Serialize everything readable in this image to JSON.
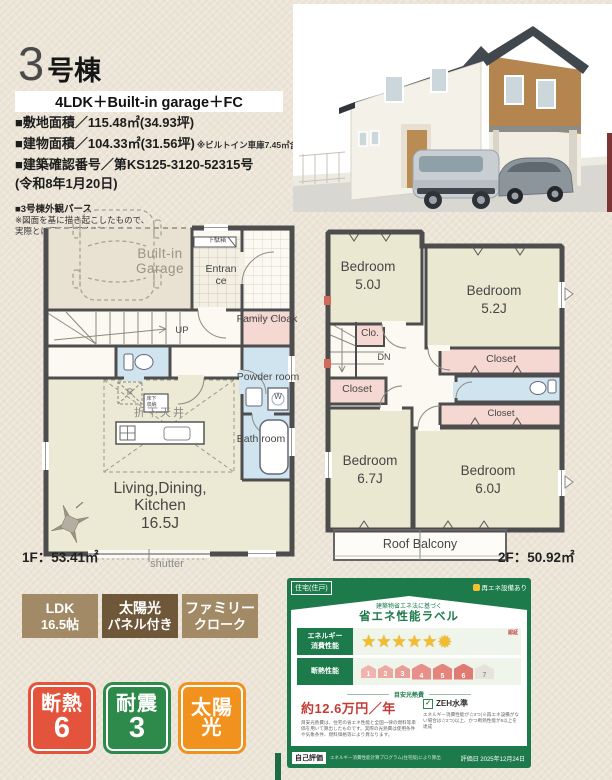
{
  "header": {
    "unit_no": "3",
    "unit_suffix": "号棟",
    "plan_type": "4LDK＋Built-in garage＋FC",
    "spec_line1": "■敷地面積／115.48㎡(34.93坪)",
    "spec_line2": "■建物面積／104.33㎡(31.56坪)",
    "spec_line2_note": "※ビルトイン車庫7.45㎡含む",
    "spec_line3": "■建築確認番号／第KS125-3120-52315号",
    "spec_line4": "(令和8年1月20日)",
    "perspective_title": "■3号棟外観パース",
    "perspective_note1": "※図面を基に描き起こしたもので、",
    "perspective_note2": "実際とは異なる場合があります。"
  },
  "plan_1f": {
    "area": "1F：53.41㎡",
    "garage": "Built-in Garage",
    "shoe_cabinet": "下駄箱",
    "entrance": "Entrance",
    "family_cloak": "Family Cloak",
    "up": "UP",
    "powder_room": "Powder room",
    "washer": "W",
    "bath_room": "Bath room",
    "fridge": "R",
    "lowered_ceiling": "折下天井",
    "floor_storage": "床下収納",
    "ldk_name": "Living,Dining, Kitchen",
    "ldk_size": "16.5J",
    "shutter": "shutter"
  },
  "plan_2f": {
    "area": "2F：50.92㎡",
    "bedroom1_name": "Bedroom",
    "bedroom1_size": "5.0J",
    "bedroom2_name": "Bedroom",
    "bedroom2_size": "5.2J",
    "bedroom3_name": "Bedroom",
    "bedroom3_size": "6.7J",
    "bedroom4_name": "Bedroom",
    "bedroom4_size": "6.0J",
    "clo": "Clo.",
    "dn": "DN",
    "closet1": "Closet",
    "closet2": "Closet",
    "closet3": "Closet",
    "roof_balcony": "Roof Balcony"
  },
  "feature_badges": {
    "b1_line1": "LDK",
    "b1_line2": "16.5帖",
    "b2_line1": "太陽光",
    "b2_line2": "パネル付き",
    "b3_line1": "ファミリー",
    "b3_line2": "クローク"
  },
  "performance_badges": {
    "b1_label": "断熱",
    "b1_value": "6",
    "b2_label": "耐震",
    "b2_value": "3",
    "b3_line1": "太陽",
    "b3_line2": "光"
  },
  "energy_label": {
    "type_badge": "住宅(住戸)",
    "renewable_badge": "再エネ設備あり",
    "law_note": "建築物省エネ法に基づく",
    "title": "省エネ性能ラベル",
    "energy_row_label1": "エネルギー",
    "energy_row_label2": "消費性能",
    "certified": "認証",
    "star_char": "★",
    "burst_char": "✹",
    "stars_total": 6,
    "insulation_label": "断熱性能",
    "levels": [
      "1",
      "2",
      "3",
      "4",
      "5",
      "6",
      "7"
    ],
    "insulation_achieved": 6,
    "cost_heading": "目安光熱費",
    "annual_cost": "約12.6万円／年",
    "zeh": "ZEH水準",
    "zeh_note": "エネルギー消費性能が☆3つ(※再エネ設備がない場合は☆2つ)以上、かつ断熱性能が5以上を達成",
    "cost_note": "目安光熱費は、住宅の省エネ性能と全国一律の燃料等単価を用いて算出したものです。実際の光熱費は使用条件や気象条件、燃料価格等により異なります。",
    "self_eval": "自己評価",
    "self_eval_note": "エネルギー消費性能計算プログラム(住宅版)により算出",
    "eval_date": "評価日 2025年12月24日"
  },
  "colors": {
    "accent_red": "#e4543c",
    "accent_green": "#2e8a4b",
    "accent_orange": "#f0921d",
    "badge_tan": "#a28a66",
    "badge_brown": "#6e5839",
    "label_green": "#1d7a4b",
    "price_red": "#c43b34",
    "wall": "#4d4d4d",
    "room_cream": "#eae8d1",
    "room_blue": "#cfe4ee",
    "room_pink": "#f6d8d2"
  }
}
